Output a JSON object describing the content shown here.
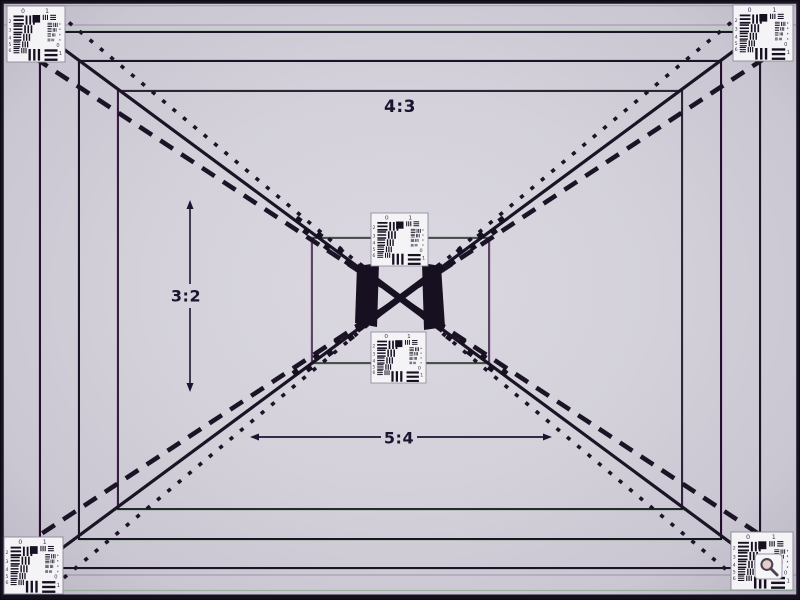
{
  "description": "Photograph of a camera lens resolution test chart with crossing diagonal lines, nested aspect-ratio frames and USAF-1951 resolution targets",
  "palette": {
    "line": "#1b1326",
    "line_soft": "#3e3750",
    "fringe_green": "#7fae7f",
    "fringe_magenta": "#c07fc6",
    "card_bg": "#f4f3f6",
    "card_border": "#8e8a99",
    "ink": "#171021",
    "label_color": "#1c1430",
    "lens_tint": "rgba(198,112,96,0.30)",
    "edge_green": "#6f9c6f"
  },
  "labels": {
    "aspect_top": "4:3",
    "aspect_left": "3:2",
    "aspect_bottom": "5:4"
  },
  "usaf": {
    "top_digits": [
      "0",
      "1"
    ],
    "left_digits": [
      "2",
      "3",
      "4",
      "5",
      "6"
    ],
    "right_digits": [
      "0",
      "1"
    ]
  },
  "geometry": {
    "frame_rects": [
      {
        "x": 2,
        "y": 2,
        "w": 796,
        "h": 596,
        "sw": 3.5,
        "outer": true
      },
      {
        "x": 40,
        "y": 32,
        "w": 720,
        "h": 536,
        "sw": 2
      },
      {
        "x": 79,
        "y": 61,
        "w": 642,
        "h": 478,
        "sw": 2
      },
      {
        "x": 118,
        "y": 91,
        "w": 564,
        "h": 418,
        "sw": 1.8
      },
      {
        "x": 312,
        "y": 238,
        "w": 177,
        "h": 125,
        "sw": 1.4
      }
    ],
    "faint_lines": [
      {
        "x1": 4,
        "y1": 25,
        "x2": 796,
        "y2": 25
      },
      {
        "x1": 4,
        "y1": 575,
        "x2": 796,
        "y2": 575
      }
    ],
    "diag_solid": [
      [
        15,
        13,
        785,
        583
      ],
      [
        785,
        13,
        15,
        583
      ]
    ],
    "diag_dashed": [
      [
        35,
        58,
        765,
        538
      ],
      [
        765,
        58,
        35,
        538
      ]
    ],
    "diag_dotted": [
      [
        60,
        15,
        740,
        581
      ],
      [
        740,
        15,
        60,
        581
      ]
    ],
    "center": {
      "cx": 400,
      "cy": 298
    },
    "center_thick": [
      [
        357,
        266,
        443,
        330
      ],
      [
        357,
        330,
        443,
        266
      ]
    ],
    "bars": [
      [
        [
          357,
          266
        ],
        [
          379,
          263
        ],
        [
          377,
          327
        ],
        [
          355,
          323
        ]
      ],
      [
        [
          422,
          263
        ],
        [
          441,
          266
        ],
        [
          445,
          327
        ],
        [
          424,
          330
        ]
      ]
    ],
    "nubs": {
      "dists": [
        50,
        63,
        76,
        89,
        102,
        115,
        128
      ],
      "size": 6
    },
    "targets": [
      {
        "x": 7,
        "y": 6,
        "w": 58,
        "h": 56,
        "name": "top-left"
      },
      {
        "x": 733,
        "y": 5,
        "w": 60,
        "h": 56,
        "name": "top-right"
      },
      {
        "x": 4,
        "y": 537,
        "w": 59,
        "h": 57,
        "name": "bottom-left"
      },
      {
        "x": 731,
        "y": 532,
        "w": 62,
        "h": 58,
        "name": "bottom-right",
        "magnifier": true
      },
      {
        "x": 371,
        "y": 213,
        "w": 57,
        "h": 53,
        "name": "center-top"
      },
      {
        "x": 371,
        "y": 332,
        "w": 55,
        "h": 51,
        "name": "center-bottom"
      }
    ],
    "magnifier": {
      "x": 755,
      "y": 554,
      "w": 27,
      "h": 25
    },
    "arrow_vertical": {
      "x": 190,
      "y1": 200,
      "y2": 392,
      "gap1": 284,
      "gap2": 308
    },
    "arrow_horizontal": {
      "y": 437,
      "x1": 250,
      "x2": 552,
      "gap1": 381,
      "gap2": 417
    },
    "label_pos": {
      "top": [
        400,
        107
      ],
      "left": [
        186,
        296
      ],
      "bottom": [
        399,
        438
      ]
    }
  }
}
